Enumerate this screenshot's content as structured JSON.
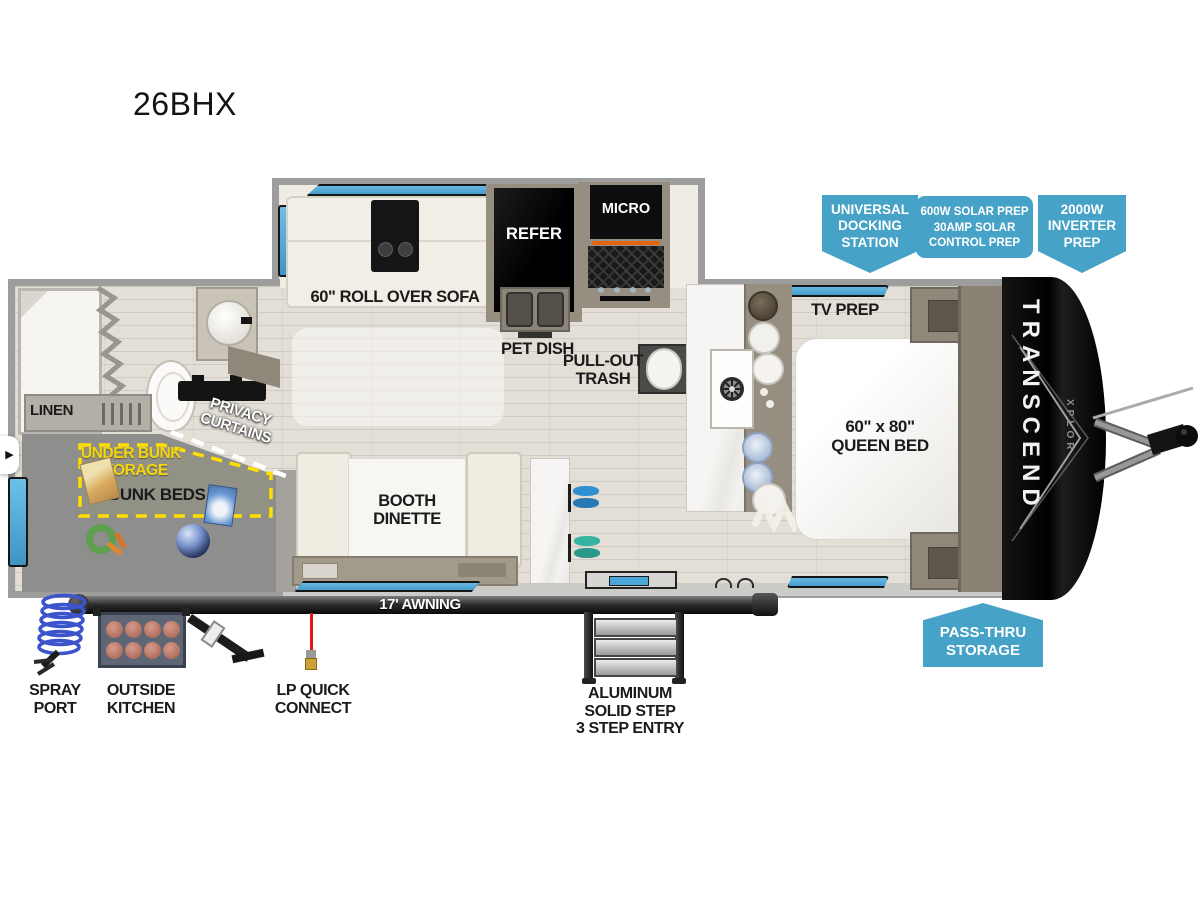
{
  "title": "26BHX",
  "colors": {
    "callout_blue": "#46a2c6",
    "dash_yellow": "#ffdf00",
    "window_blue": "#4fb0e2",
    "lp_red": "#e31515",
    "wall_gray": "#9d9d9d"
  },
  "callouts": {
    "universal_docking": [
      "UNIVERSAL",
      "DOCKING",
      "STATION"
    ],
    "solar_prep": [
      "600W SOLAR PREP",
      "30AMP SOLAR",
      "CONTROL PREP"
    ],
    "inverter_prep": [
      "2000W",
      "INVERTER",
      "PREP"
    ],
    "pass_thru_storage": [
      "PASS-THRU",
      "STORAGE"
    ]
  },
  "interior": {
    "sofa": "60\" ROLL OVER SOFA",
    "refer": "REFER",
    "micro": "MICRO",
    "pet_dish": "PET DISH",
    "pull_out_trash": [
      "PULL-OUT",
      "TRASH"
    ],
    "tv_prep": "TV PREP",
    "queen_bed": [
      "60\" x 80\"",
      "QUEEN BED"
    ],
    "linen": "LINEN",
    "privacy_curtains": [
      "PRIVACY",
      "CURTAINS"
    ],
    "under_bunk_storage": [
      "UNDER BUNK",
      "STORAGE"
    ],
    "bunk_beds": "BUNK BEDS",
    "booth_dinette": [
      "BOOTH",
      "DINETTE"
    ]
  },
  "exterior": {
    "awning": "17' AWNING",
    "spray_port": [
      "SPRAY",
      "PORT"
    ],
    "outside_kitchen": [
      "OUTSIDE",
      "KITCHEN"
    ],
    "lp_quick_connect": [
      "LP QUICK",
      "CONNECT"
    ],
    "entry_step": [
      "ALUMINUM",
      "SOLID STEP",
      "3 STEP ENTRY"
    ]
  },
  "branding": {
    "model": "TRANSCEND",
    "series": "XPLOR"
  },
  "nav": {
    "arrow": "▶"
  }
}
